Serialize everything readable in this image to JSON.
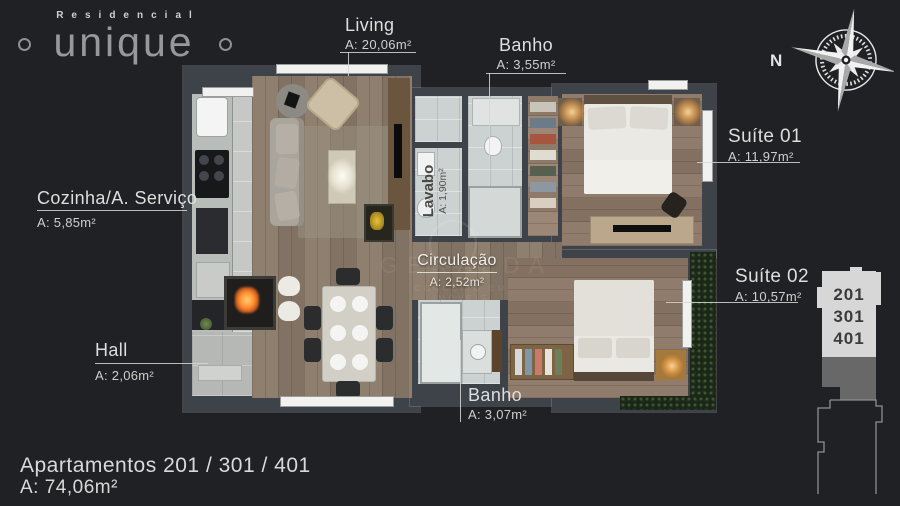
{
  "logo": {
    "script": "Residencial",
    "name": "unique"
  },
  "compass": {
    "label": "N"
  },
  "rooms": {
    "living": {
      "name": "Living",
      "area": "A: 20,06m²"
    },
    "banho1": {
      "name": "Banho",
      "area": "A: 3,55m²"
    },
    "suite1": {
      "name": "Suíte 01",
      "area": "A: 11,97m²"
    },
    "suite2": {
      "name": "Suíte 02",
      "area": "A: 10,57m²"
    },
    "cozinha": {
      "name": "Cozinha/A. Serviço",
      "area": "A: 5,85m²"
    },
    "lavabo": {
      "name": "Lavabo",
      "area": "A: 1,90m²"
    },
    "circulacao": {
      "name": "Circulação",
      "area": "A: 2,52m²"
    },
    "hall": {
      "name": "Hall",
      "area": "A: 2,06m²"
    },
    "banho2": {
      "name": "Banho",
      "area": "A: 3,07m²"
    }
  },
  "footer": {
    "title": "Apartamentos 201 / 301 / 401",
    "area": "A: 74,06m²"
  },
  "building_badge": {
    "floors": [
      "201",
      "301",
      "401"
    ]
  },
  "watermark": {
    "name": "GERALDA",
    "tagline": "CONCEITO EM IMÓVEIS"
  },
  "colors": {
    "background": "#202124",
    "label_text": "#dcdcdc",
    "wall": "#3e434a",
    "wood_floor": "#857465",
    "tile_floor": "#c5c8c5",
    "hedge_green": "#1b2619",
    "badge_light": "#d7d7d7",
    "badge_mid": "#686868",
    "fire_orange": "#ff8a2a"
  }
}
